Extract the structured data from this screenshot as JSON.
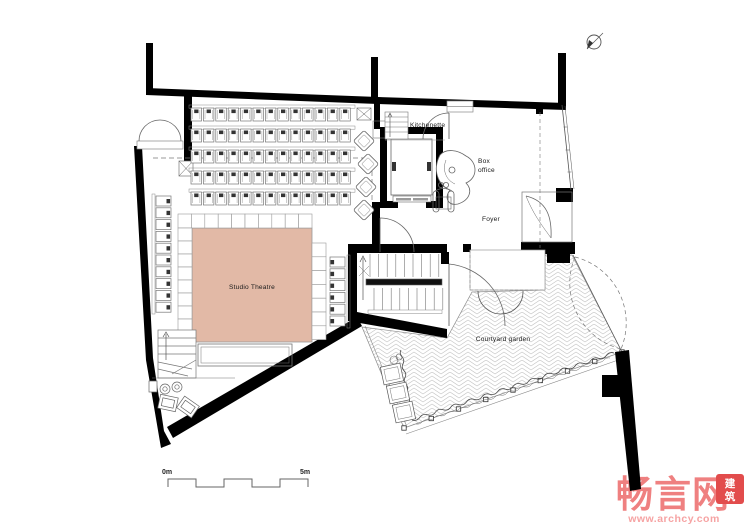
{
  "drawing": {
    "type": "architectural-floor-plan",
    "labels": {
      "kitchenette": "Kitchenette",
      "box_office_line1": "Box",
      "box_office_line2": "office",
      "foyer": "Foyer",
      "studio_theatre": "Studio Theatre",
      "courtyard_garden": "Courtyard garden"
    },
    "scale_bar": {
      "start": "0m",
      "end": "5m",
      "segments": 5
    },
    "seating": {
      "main_rows": 5,
      "seats_per_row": 13,
      "left_side_seats": 10,
      "right_side_seats": 6,
      "lounge_chairs": 4
    },
    "colors": {
      "wall": "#000000",
      "line": "#555555",
      "light_line": "#8d8d8d",
      "paving_line": "#c3c3c3",
      "stage_fill": "#e2b9a6",
      "label": "#1a1a1a"
    }
  },
  "watermark": {
    "logo_text": "畅言网",
    "seal_char1": "建",
    "seal_char2": "筑",
    "url": "www.archcy.com",
    "colors": {
      "logo_pink": "#ef8080",
      "url_pink": "#f6a3a3",
      "seal_red": "#e24c4c"
    }
  }
}
